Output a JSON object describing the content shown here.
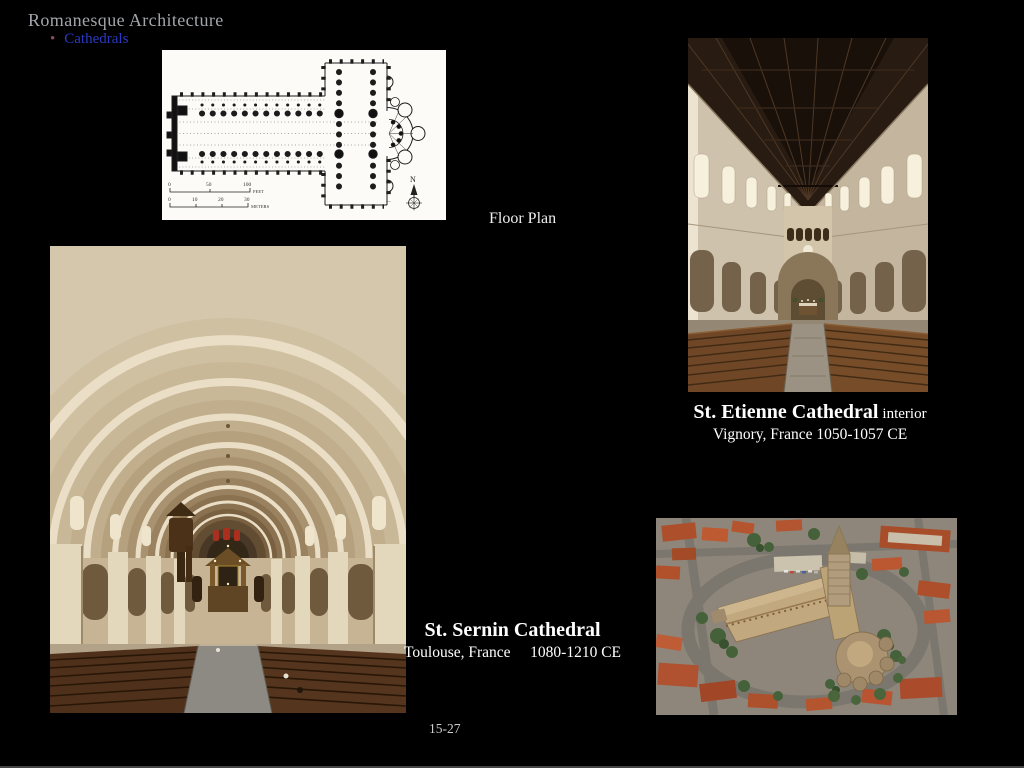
{
  "slide": {
    "title": "Romanesque Architecture",
    "bullet_marker": "•",
    "bullet_label": "Cathedrals",
    "page_number": "15-27"
  },
  "colors": {
    "background": "#000000",
    "title_text": "#a2a6aa",
    "bullet_link": "#2c39c6",
    "caption_text": "#ffffff",
    "floor_plan_paper": "#fcfbf7"
  },
  "floor_plan": {
    "label": "Floor Plan",
    "compass_label": "N",
    "scale_feet": {
      "t0": "0",
      "t1": "50",
      "t2": "100",
      "unit": "FEET"
    },
    "scale_meters": {
      "t0": "0",
      "t1": "10",
      "t2": "20",
      "t3": "30",
      "unit": "METERS"
    }
  },
  "st_etienne": {
    "caption_title": "St. Etienne Cathedral",
    "caption_qualifier": "interior",
    "caption_line2": "Vignory, France 1050-1057 CE"
  },
  "st_sernin": {
    "caption_title": "St. Sernin Cathedral",
    "caption_location": "Toulouse, France",
    "caption_date": "1080-1210 CE"
  }
}
